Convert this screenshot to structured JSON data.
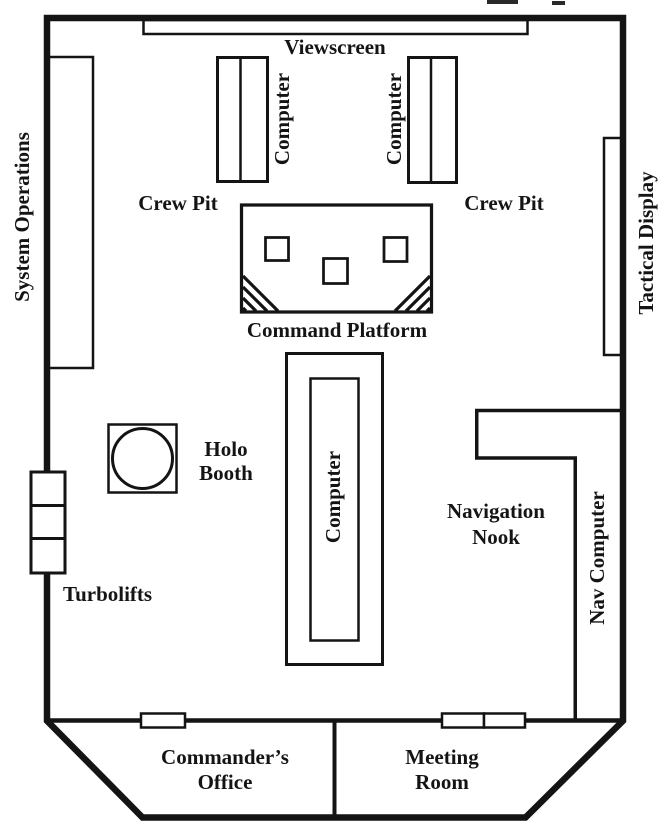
{
  "plan_title": "Starship Bridge Floor Plan",
  "colors": {
    "ink": "#141414",
    "background": "#ffffff"
  },
  "rooms": {
    "viewscreen": "Viewscreen",
    "system_operations": "System Operations",
    "tactical_display": "Tactical Display",
    "crew_pit_left": "Crew Pit",
    "crew_pit_right": "Crew Pit",
    "computer_top_left": "Computer",
    "computer_top_right": "Computer",
    "computer_center": "Computer",
    "command_platform": "Command Platform",
    "holo_booth": {
      "line1": "Holo",
      "line2": "Booth"
    },
    "navigation_nook": {
      "line1": "Navigation",
      "line2": "Nook"
    },
    "nav_computer": "Nav Computer",
    "turbolifts": "Turbolifts",
    "commanders_office": {
      "line1": "Commander’s",
      "line2": "Office"
    },
    "meeting_room": {
      "line1": "Meeting",
      "line2": "Room"
    }
  }
}
